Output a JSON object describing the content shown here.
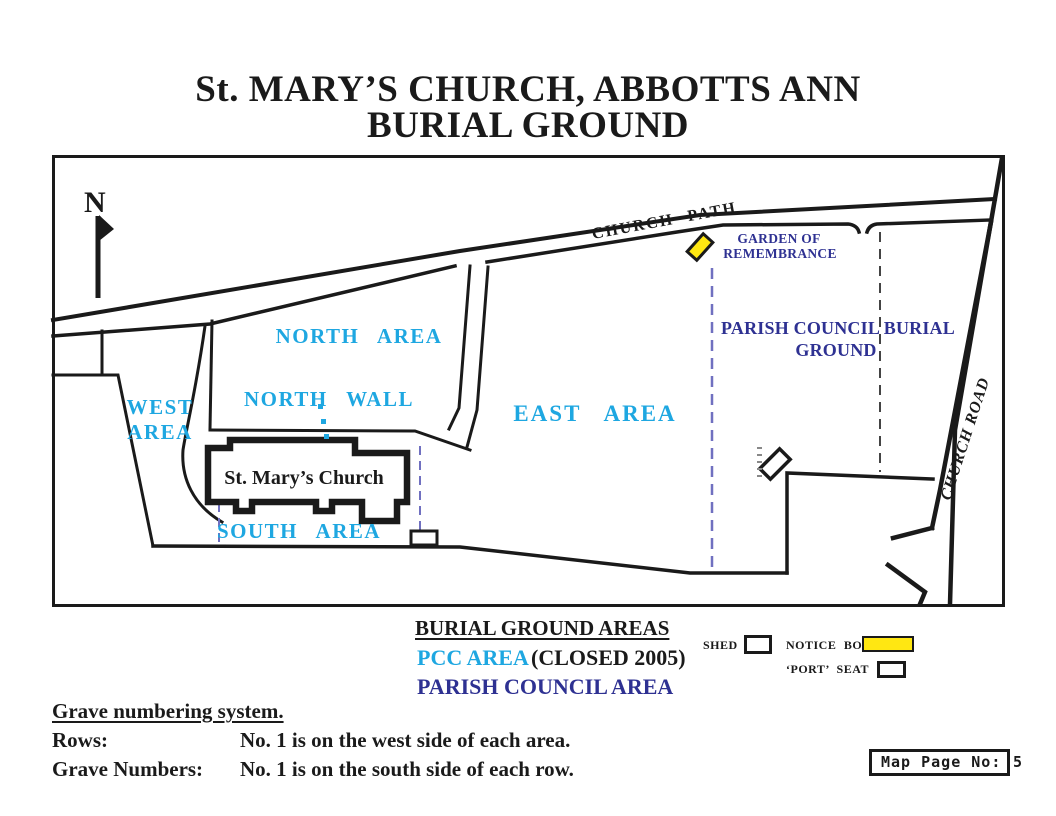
{
  "title": {
    "line1": "St. MARY’S CHURCH, ABBOTTS ANN",
    "line2": "BURIAL GROUND"
  },
  "map": {
    "north_indicator": "N",
    "labels": {
      "church_path": "CHURCH PATH",
      "garden_line1": "GARDEN OF",
      "garden_line2": "REMEMBRANCE",
      "north_area": "NORTH AREA",
      "north_wall": "NORTH WALL",
      "west_line1": "WEST",
      "west_line2": "AREA",
      "east_area": "EAST AREA",
      "south_area": "SOUTH AREA",
      "church": "St. Mary’s Church",
      "parish_line1": "PARISH COUNCIL BURIAL",
      "parish_line2": "GROUND",
      "church_road": "CHURCH ROAD"
    },
    "symbols": {
      "notice_board": "notice-board-marker",
      "shed": "shed-marker",
      "port_seat": "port-seat-marker"
    }
  },
  "legend": {
    "heading": "BURIAL GROUND AREAS",
    "pcc_area": "PCC AREA",
    "pcc_note": "(CLOSED 2005)",
    "parish_area": "PARISH COUNCIL AREA",
    "shed": "SHED",
    "notice_board": "NOTICE BOARD",
    "port_seat": "‘PORT’ SEAT"
  },
  "footer": {
    "heading": "Grave numbering system.",
    "rows_label": "Rows:",
    "rows_text": "No. 1 is on the west side of each area.",
    "graves_label": "Grave Numbers:",
    "graves_text": "No. 1 is on the south side of each row."
  },
  "page_box": {
    "label": "Map Page No:",
    "number": "5"
  },
  "colors": {
    "pcc_cyan": "#1EA7E1",
    "parish_navy": "#2E3192",
    "notice_yellow": "#FFE712",
    "dashed_blue": "#7070C0",
    "line_black": "#1a1a1a"
  }
}
